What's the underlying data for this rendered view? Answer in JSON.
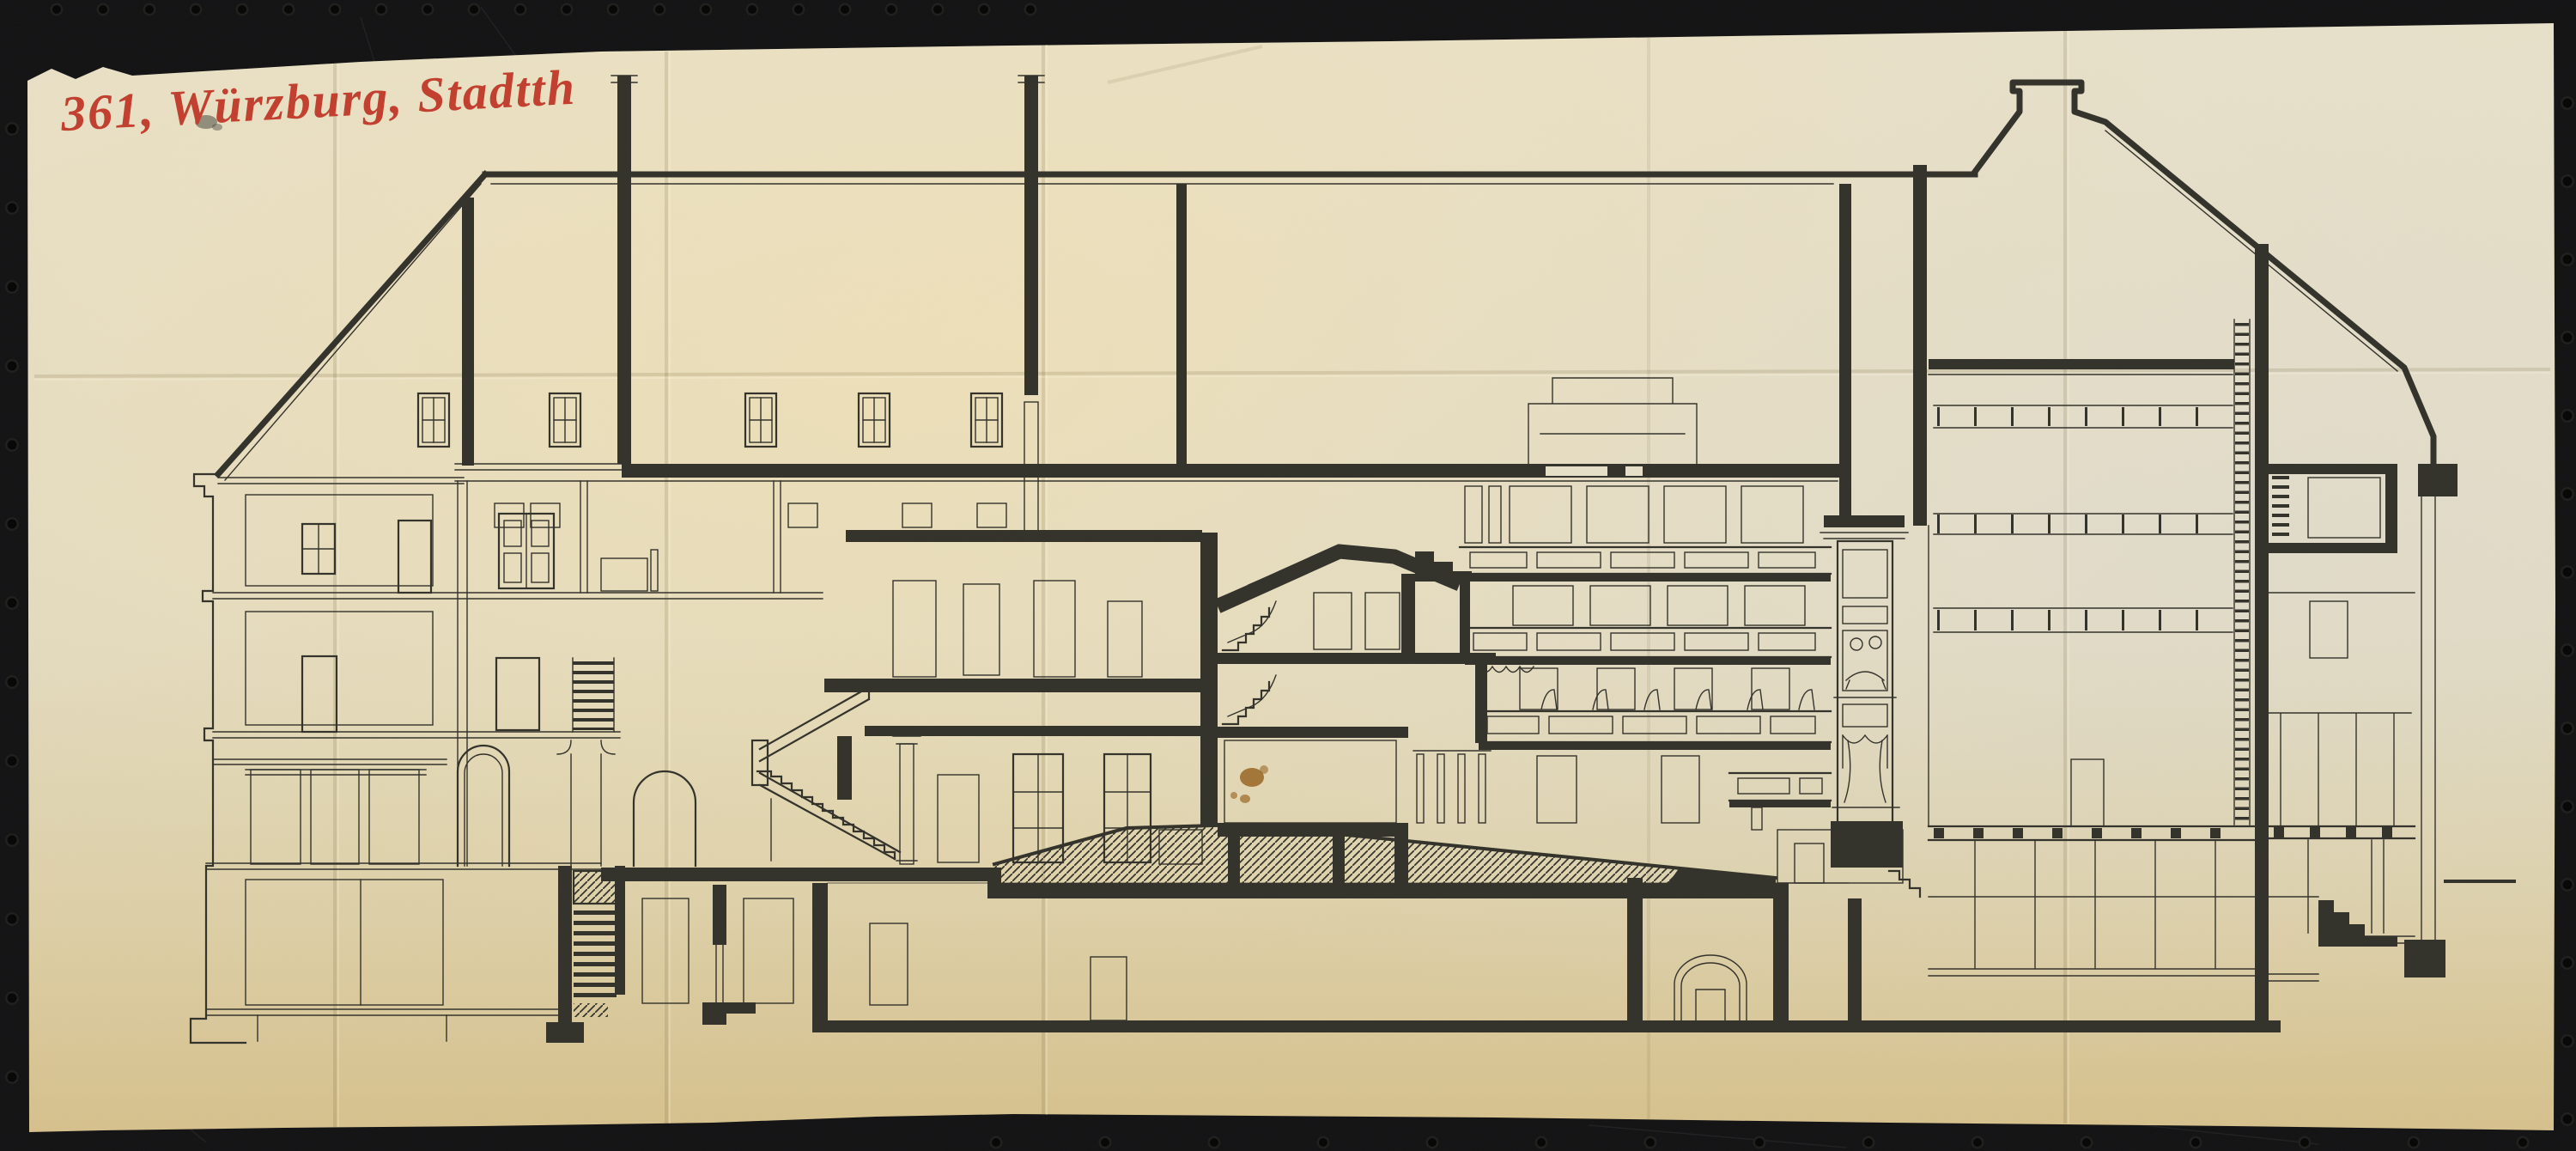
{
  "annotation": {
    "text": "361, Würzburg, Stadtth",
    "color": "#c2402f"
  },
  "palette": {
    "background": "#121214",
    "ink": "#34332c",
    "paperlite": "#e6dfc8",
    "paper_top": "#e9e2cb",
    "paper_mid": "#e4dcc2",
    "paper_low": "#dfd2ab",
    "paper_bottom": "#d7c28e",
    "stain": "#945f1c",
    "hole": "#050505"
  }
}
